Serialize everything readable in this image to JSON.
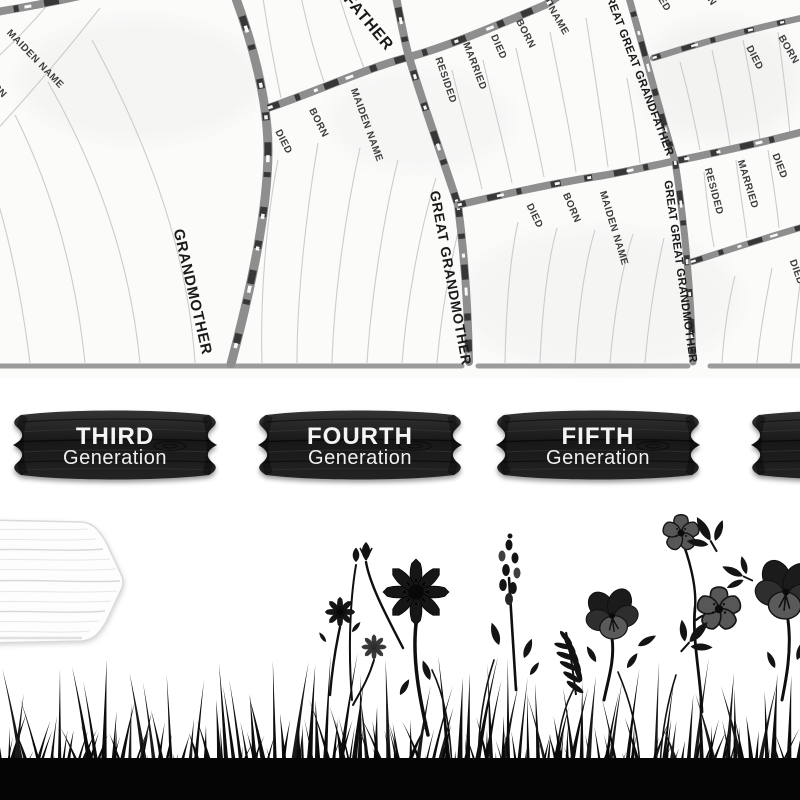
{
  "chart": {
    "title_hint": "family tree fan chart",
    "sectors": {
      "grandmother": "GRANDMOTHER",
      "great_grandmother": "GREAT GRANDMOTHER",
      "great_grandfather": "GREAT GRANDFATHER",
      "great_great_grandfather": "GREAT GREAT GRANDFATHER",
      "great_great_grandmother": "GREAT GREAT GRANDMOTHER"
    },
    "fields": {
      "name": "NAME",
      "born": "BORN",
      "died": "DIED",
      "married": "MARRIED",
      "resided": "RESIDED",
      "maiden_name": "MAIDEN NAME"
    }
  },
  "plaques": [
    {
      "ordinal": "THIRD",
      "word": "Generation"
    },
    {
      "ordinal": "FOURTH",
      "word": "Generation"
    },
    {
      "ordinal": "FIFTH",
      "word": "Generation"
    }
  ],
  "colors": {
    "chart_background": "#fbfbfa",
    "branch_gray": "#8e8e8e",
    "branch_dark": "#373737",
    "ruled_line": "#cccccc",
    "plaque_wood": "#1e1e1e",
    "plaque_text": "#f4f4f4",
    "silhouette_black": "#0b0b0b",
    "sign_wood": "#fdfdfd"
  }
}
